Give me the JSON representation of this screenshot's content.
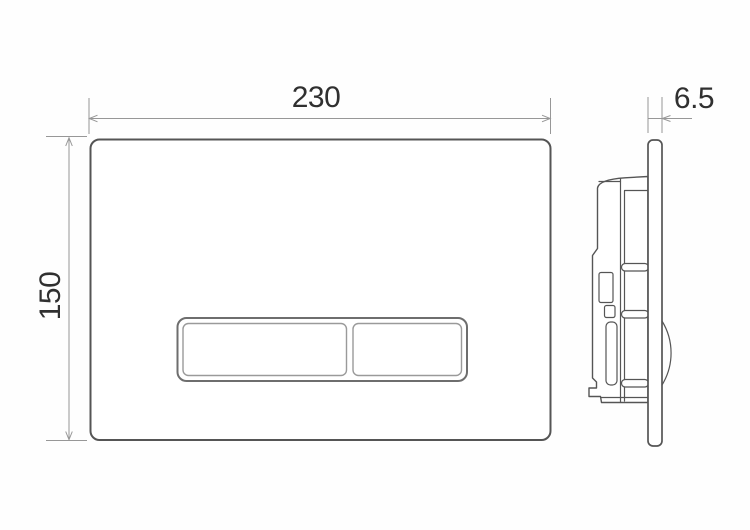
{
  "drawing": {
    "type": "technical-dimension-drawing",
    "subject": "wc-flush-actuator-plate",
    "views": {
      "count": 2
    }
  },
  "dimensions": {
    "width": "230",
    "height": "150",
    "depth": "6.5"
  },
  "colors": {
    "background": "#fefefe",
    "outline_dark": "#555555",
    "outline_medium": "#9a9a9a",
    "frame_gray": "#6e6e6e",
    "dimension_gray": "#979797",
    "text": "#303030"
  }
}
